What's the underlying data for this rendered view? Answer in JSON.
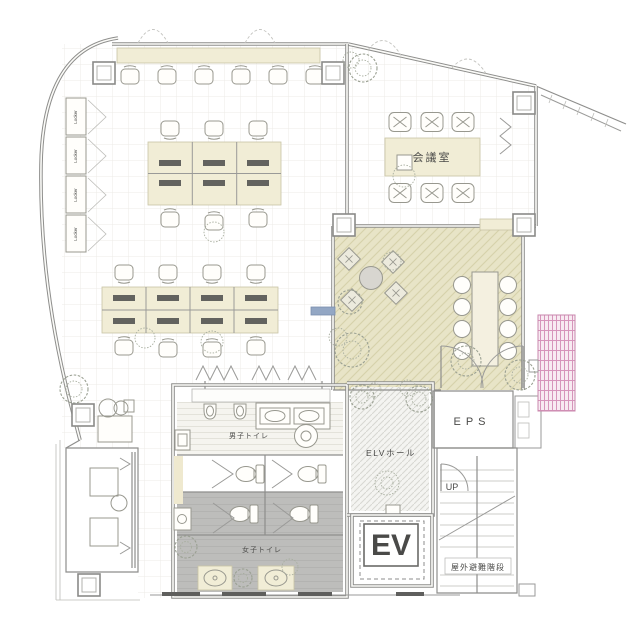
{
  "floor_plan": {
    "drawing_type": "office floor plan",
    "labels": {
      "meeting_room": "会議室",
      "elv_hall": "ELVホール",
      "elevator": "EV",
      "eps": "EPS",
      "up": "UP",
      "outdoor_evac_stairs": "屋外避難階段",
      "mens_toilet": "男子トイレ",
      "womens_toilet": "女子トイレ",
      "locker": "Locker"
    },
    "colors": {
      "wall_line": "#8e8e8c",
      "accent_beige": "#f1edd6",
      "terrace_floor": "#e8e4c7",
      "gray_floor": "#bdbdbb",
      "lattice_pink": "#d795bb",
      "text": "#4a4a48"
    },
    "furniture_counts": {
      "counter_chairs": 6,
      "desk_cluster_1": {
        "columns": 3,
        "rows": 2
      },
      "desk_cluster_2": {
        "columns": 4,
        "rows": 2
      },
      "meeting_chairs": 6,
      "terrace_stools": 8,
      "cafe_chairs": 4,
      "lockers": 4,
      "urinals": 2,
      "toilet_stalls": 4,
      "vanity_sinks": 2
    }
  }
}
